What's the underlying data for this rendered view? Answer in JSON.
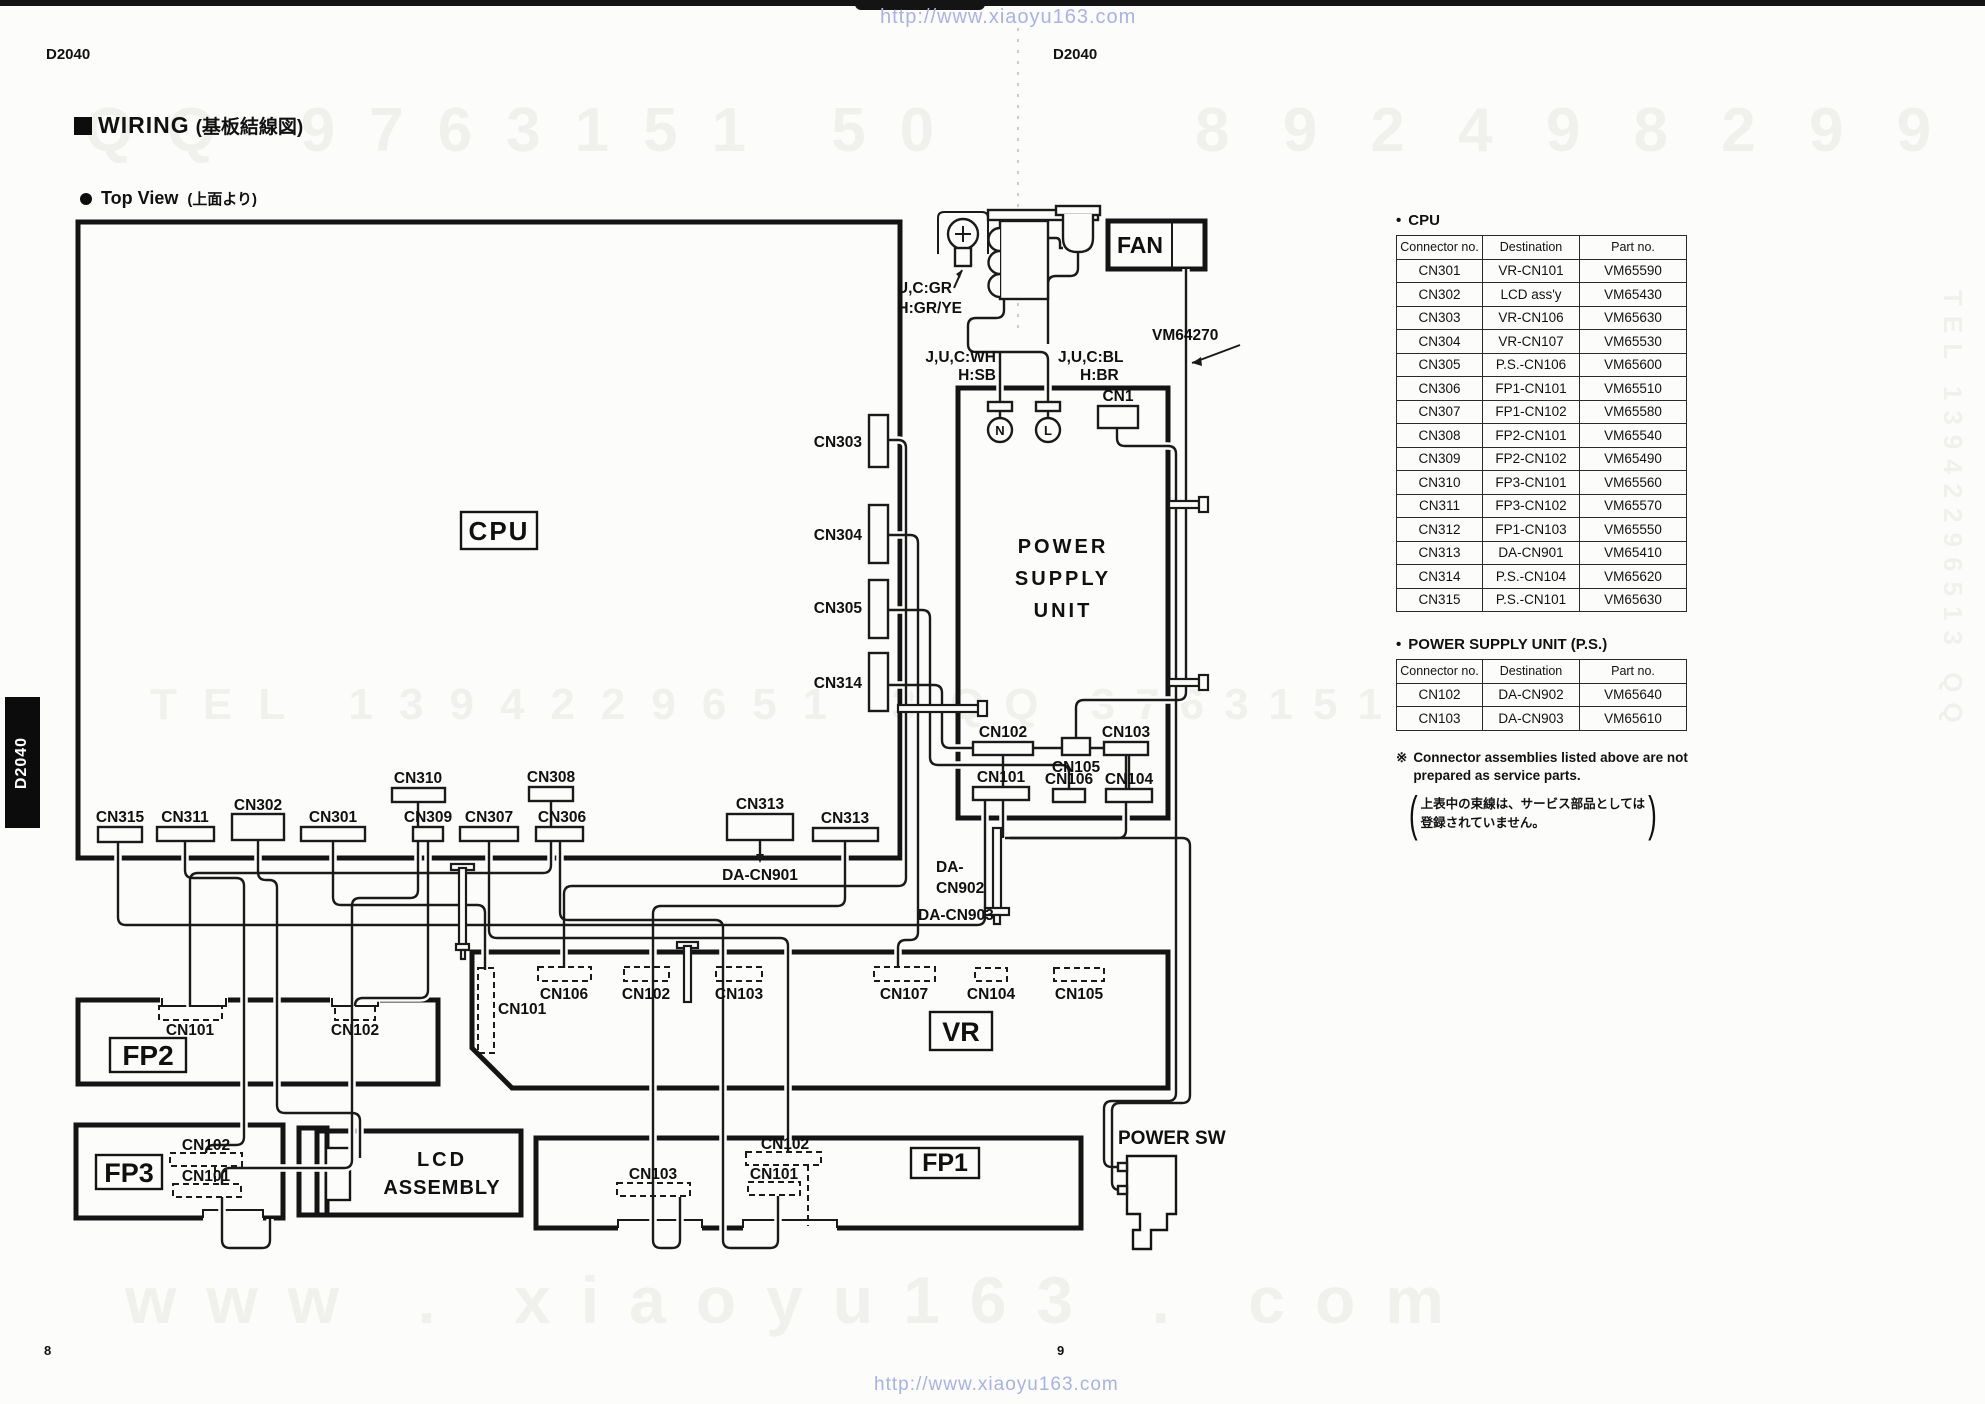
{
  "page": {
    "model_left": "D2040",
    "model_center": "D2040",
    "side_tab": "D2040",
    "page_no_left": "8",
    "page_no_right": "9"
  },
  "watermarks": {
    "url_top": "http://www.xiaoyu163.com",
    "url_bottom": "http://www.xiaoyu163.com",
    "ghost_top_left": "QQ 9763151 50",
    "ghost_top_right": "8 9 2 4 9 8 2 9 9",
    "ghost_mid_left": "TEL 1394229651 3",
    "ghost_mid_right": "QQ 37631515 8299",
    "ghost_bottom": "www . xiaoyu163 . com",
    "ghost_right_edge": "TEL 13942296513 QQ"
  },
  "headings": {
    "section": "WIRING",
    "section_jp": "(基板結線図)",
    "subsection": "Top View",
    "subsection_jp": "(上面より)"
  },
  "diagram": {
    "labels": {
      "cpu": "CPU",
      "psu_1": "POWER",
      "psu_2": "SUPPLY",
      "psu_3": "UNIT",
      "fan": "FAN",
      "cn1": "CN1",
      "vm64270": "VM64270",
      "n": "N",
      "l": "L",
      "uc_gr": "U,C:GR",
      "h_grye": "H:GR/YE",
      "juc_wh": "J,U,C:WH",
      "h_sb": "H:SB",
      "juc_bl": "J,U,C:BL",
      "h_br": "H:BR",
      "cn303": "CN303",
      "cn304": "CN304",
      "cn305": "CN305",
      "cn314": "CN314",
      "cn315": "CN315",
      "cn311": "CN311",
      "cn302": "CN302",
      "cn301": "CN301",
      "cn310": "CN310",
      "cn309": "CN309",
      "cn307": "CN307",
      "cn308": "CN308",
      "cn306": "CN306",
      "cn313a": "CN313",
      "cn313b": "CN313",
      "da_cn901": "DA-CN901",
      "da_cn902_1": "DA-",
      "da_cn902_2": "CN902",
      "da_cn903": "DA-CN903",
      "ps_cn102": "CN102",
      "ps_cn105": "CN105",
      "ps_cn103": "CN103",
      "ps_cn101": "CN101",
      "ps_cn106": "CN106",
      "ps_cn104": "CN104",
      "vr": "VR",
      "vr_cn101": "CN101",
      "vr_cn106": "CN106",
      "vr_cn102": "CN102",
      "vr_cn103": "CN103",
      "vr_cn107": "CN107",
      "vr_cn104": "CN104",
      "vr_cn105": "CN105",
      "fp2": "FP2",
      "fp2_cn101": "CN101",
      "fp2_cn102": "CN102",
      "fp3": "FP3",
      "fp3_cn101": "CN101",
      "fp3_cn102": "CN102",
      "lcd_1": "LCD",
      "lcd_2": "ASSEMBLY",
      "fp1": "FP1",
      "fp1_cn101": "CN101",
      "fp1_cn102": "CN102",
      "fp1_cn103": "CN103",
      "power_sw": "POWER SW"
    }
  },
  "tables": {
    "bullet": "•",
    "cpu": {
      "title": "CPU",
      "headers": [
        "Connector no.",
        "Destination",
        "Part no."
      ],
      "rows": [
        [
          "CN301",
          "VR-CN101",
          "VM65590"
        ],
        [
          "CN302",
          "LCD ass'y",
          "VM65430"
        ],
        [
          "CN303",
          "VR-CN106",
          "VM65630"
        ],
        [
          "CN304",
          "VR-CN107",
          "VM65530"
        ],
        [
          "CN305",
          "P.S.-CN106",
          "VM65600"
        ],
        [
          "CN306",
          "FP1-CN101",
          "VM65510"
        ],
        [
          "CN307",
          "FP1-CN102",
          "VM65580"
        ],
        [
          "CN308",
          "FP2-CN101",
          "VM65540"
        ],
        [
          "CN309",
          "FP2-CN102",
          "VM65490"
        ],
        [
          "CN310",
          "FP3-CN101",
          "VM65560"
        ],
        [
          "CN311",
          "FP3-CN102",
          "VM65570"
        ],
        [
          "CN312",
          "FP1-CN103",
          "VM65550"
        ],
        [
          "CN313",
          "DA-CN901",
          "VM65410"
        ],
        [
          "CN314",
          "P.S.-CN104",
          "VM65620"
        ],
        [
          "CN315",
          "P.S.-CN101",
          "VM65630"
        ]
      ]
    },
    "psu": {
      "title": "POWER SUPPLY UNIT (P.S.)",
      "headers": [
        "Connector no.",
        "Destination",
        "Part no."
      ],
      "rows": [
        [
          "CN102",
          "DA-CN902",
          "VM65640"
        ],
        [
          "CN103",
          "DA-CN903",
          "VM65610"
        ]
      ]
    },
    "note_mark": "※",
    "note_en_1": "Connector assemblies listed above are not",
    "note_en_2": "prepared as service parts.",
    "note_jp_1": "上表中の束線は、サービス部品としては",
    "note_jp_2": "登録されていません。"
  }
}
